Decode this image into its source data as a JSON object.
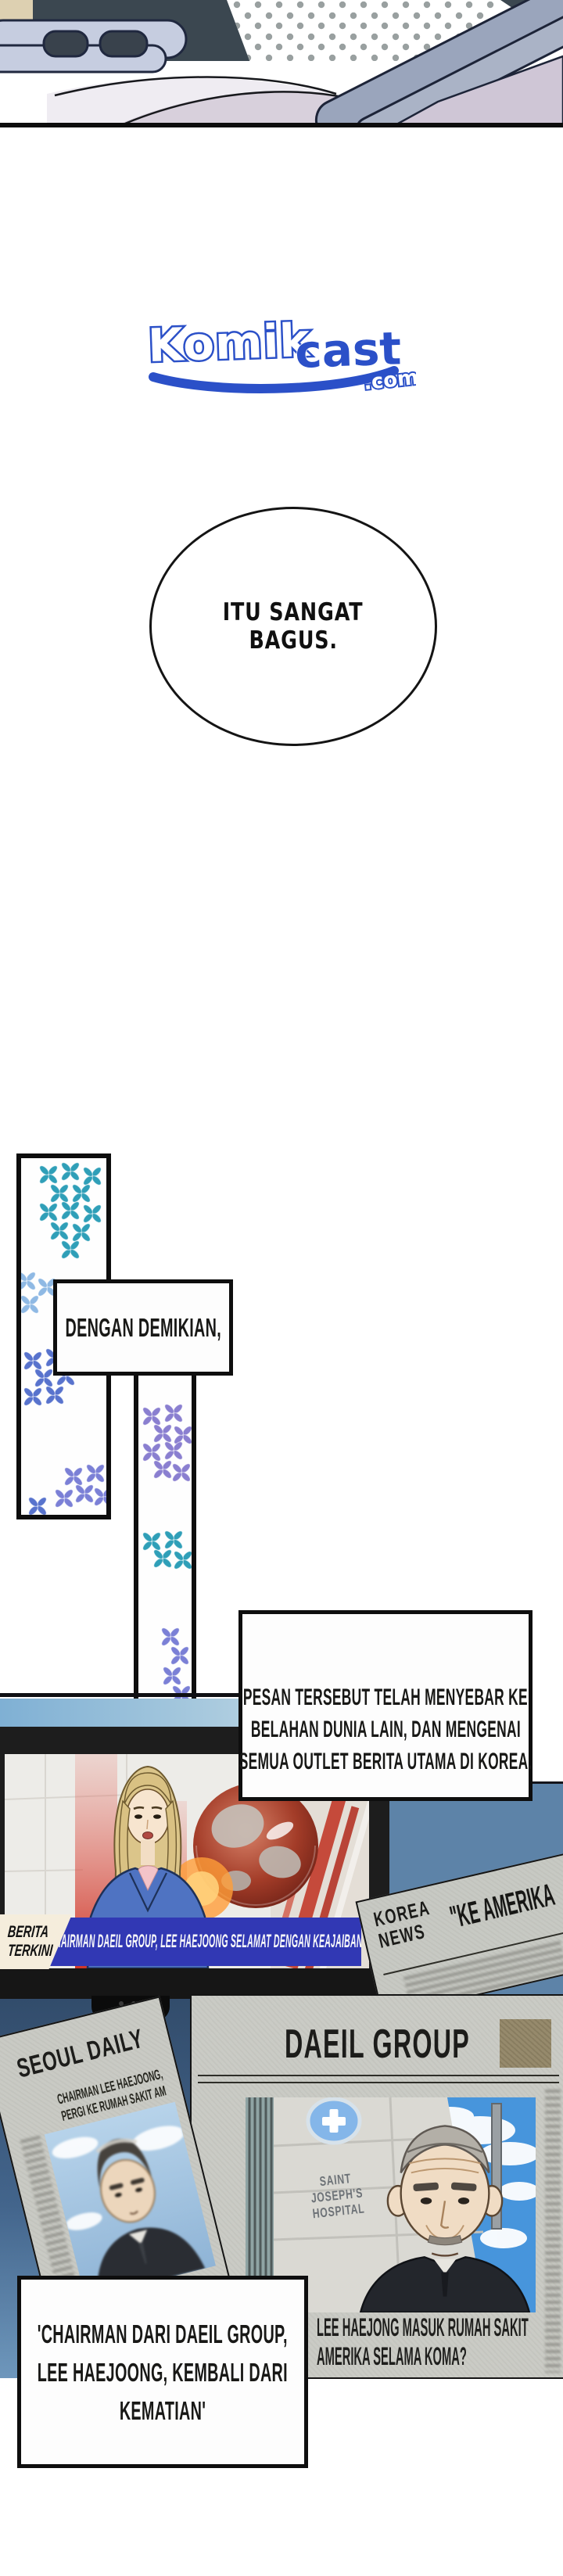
{
  "logo": {
    "komik": "Komik",
    "cast": "cast",
    "dotcom": ".com",
    "brand_blue": "#2b50c8"
  },
  "bubble": {
    "line1": "ITU SANGAT",
    "line2": "BAGUS."
  },
  "boxes": {
    "dengan": {
      "line1": "DENGAN DEMIKIAN,"
    },
    "pesan": {
      "line1": "PESAN TERSEBUT TELAH MENYEBAR KE",
      "line2": "BELAHAN DUNIA LAIN, DAN MENGENAI",
      "line3": "SEMUA OUTLET BERITA UTAMA DI KOREA."
    },
    "chairman": {
      "line1": "'CHAIRMAN DARI DAEIL GROUP,",
      "line2": "LEE HAEJOONG, KEMBALI DARI",
      "line3": "KEMATIAN'"
    }
  },
  "tv": {
    "label_line1": "BERITA",
    "label_line2": "TERKINI",
    "ticker": "\"CHAIRMAN DAEIL GROUP, LEE HAEJOONG SELAMAT DENGAN KEAJAIBAN\"",
    "banner_color": "#3138b4"
  },
  "newspapers": {
    "korea": {
      "name1": "KOREA",
      "name2": "NEWS",
      "headline": "\"KE AMERIKA"
    },
    "seoul": {
      "title": "SEOUL DAILY",
      "sub1": "CHAIRMAN LEE HAEJOONG,",
      "sub2": "PERGI KE RUMAH SAKIT AM"
    },
    "daeil": {
      "title": "DAEIL GROUP",
      "caption1": "LEE HAEJONG MASUK RUMAH SAKIT",
      "caption2": "AMERIKA SELAMA KOMA?"
    },
    "hospital_sign": {
      "line1": "SAINT",
      "line2": "JOSEPH'S",
      "line3": "HOSPITAL"
    }
  }
}
